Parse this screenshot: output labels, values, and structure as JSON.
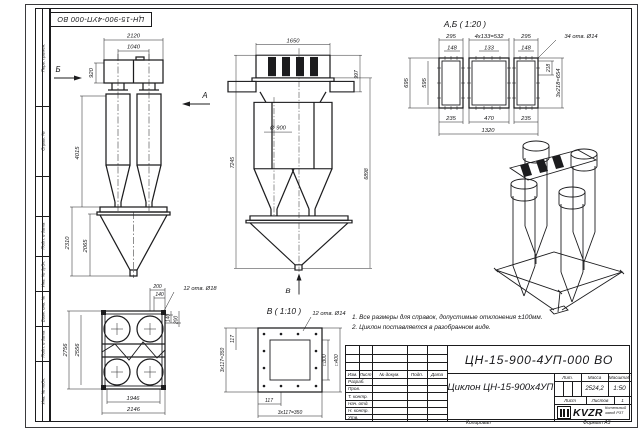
{
  "frame": {
    "top_stamp": "ЦН-15-900-4УП-000 ВО",
    "margin_labels": [
      "Перв. примен.",
      "Справ. №",
      "Подп. и дата",
      "Инв. № дубл.",
      "Взам. инв. №",
      "Подп. и дата",
      "Инв. № подл."
    ],
    "copy_label": "Копировал",
    "format_label": "Формат А3"
  },
  "front_view": {
    "dim_2120": "2120",
    "dim_1040": "1040",
    "dim_920": "920",
    "dim_4015": "4015",
    "dim_2310": "2310",
    "dim_2065": "2065",
    "arrow_a": "А",
    "arrow_b": "Б"
  },
  "side_view": {
    "dim_1650": "1650",
    "dim_997": "997",
    "dim_d900": "Ø 900",
    "dim_7245": "7245",
    "dim_6898": "6898",
    "arrow_v": "В"
  },
  "ab_view": {
    "title": "А,Б ( 1:20 )",
    "holes": "34 отв. Ø14",
    "dim_295_l": "295",
    "dim_4x133": "4х133=532",
    "dim_295_r": "295",
    "dim_148_l": "148",
    "dim_133": "133",
    "dim_148_r": "148",
    "dim_695": "695",
    "dim_595": "595",
    "dim_218": "218",
    "dim_3x218": "3х218=654",
    "dim_235_l": "235",
    "dim_470": "470",
    "dim_235_r": "235",
    "dim_1320": "1320"
  },
  "plan_view": {
    "dim_200_top": "200",
    "dim_140_top": "140",
    "holes": "12 отв. Ø18",
    "dim_140_r": "140",
    "dim_200_r": "200",
    "dim_2756": "2756",
    "dim_2556": "2556",
    "dim_1946": "1946",
    "dim_2146": "2146"
  },
  "v_view": {
    "title": "В ( 1:10 )",
    "holes": "12 отв. Ø14",
    "dim_3x117_left": "3х117=350",
    "dim_117_left": "117",
    "dim_300": "□300",
    "dim_400": "□400",
    "dim_117_bottom": "117",
    "dim_3x117_bottom": "3х117=350"
  },
  "notes": {
    "line1": "1. Все размеры для справок, допустимые отклонения ±100мм.",
    "line2": "2. Циклон поставляется в разобранном виде."
  },
  "title_block": {
    "doc_number": "ЦН-15-900-4УП-000 ВО",
    "product_name": "Циклон ЦН-15-900х4УП",
    "columns": {
      "izm": "Изм.",
      "list": "Лист",
      "doc": "№ докум.",
      "podp": "Подп.",
      "data": "Дата"
    },
    "rows": [
      "Разраб.",
      "Пров.",
      "Т. контр.",
      "Нач. отд.",
      "Н. контр.",
      "Утв."
    ],
    "lit_label": "Лит.",
    "mass_label": "Масса",
    "scale_label": "Масштаб",
    "mass_value": "2524,2",
    "scale_value": "1:50",
    "sheet_label": "Лист",
    "sheets_label": "Листов",
    "sheets_value": "1",
    "logo_text": "KVZR",
    "company_line1": "Котельный",
    "company_line2": "завод РЗТ"
  }
}
